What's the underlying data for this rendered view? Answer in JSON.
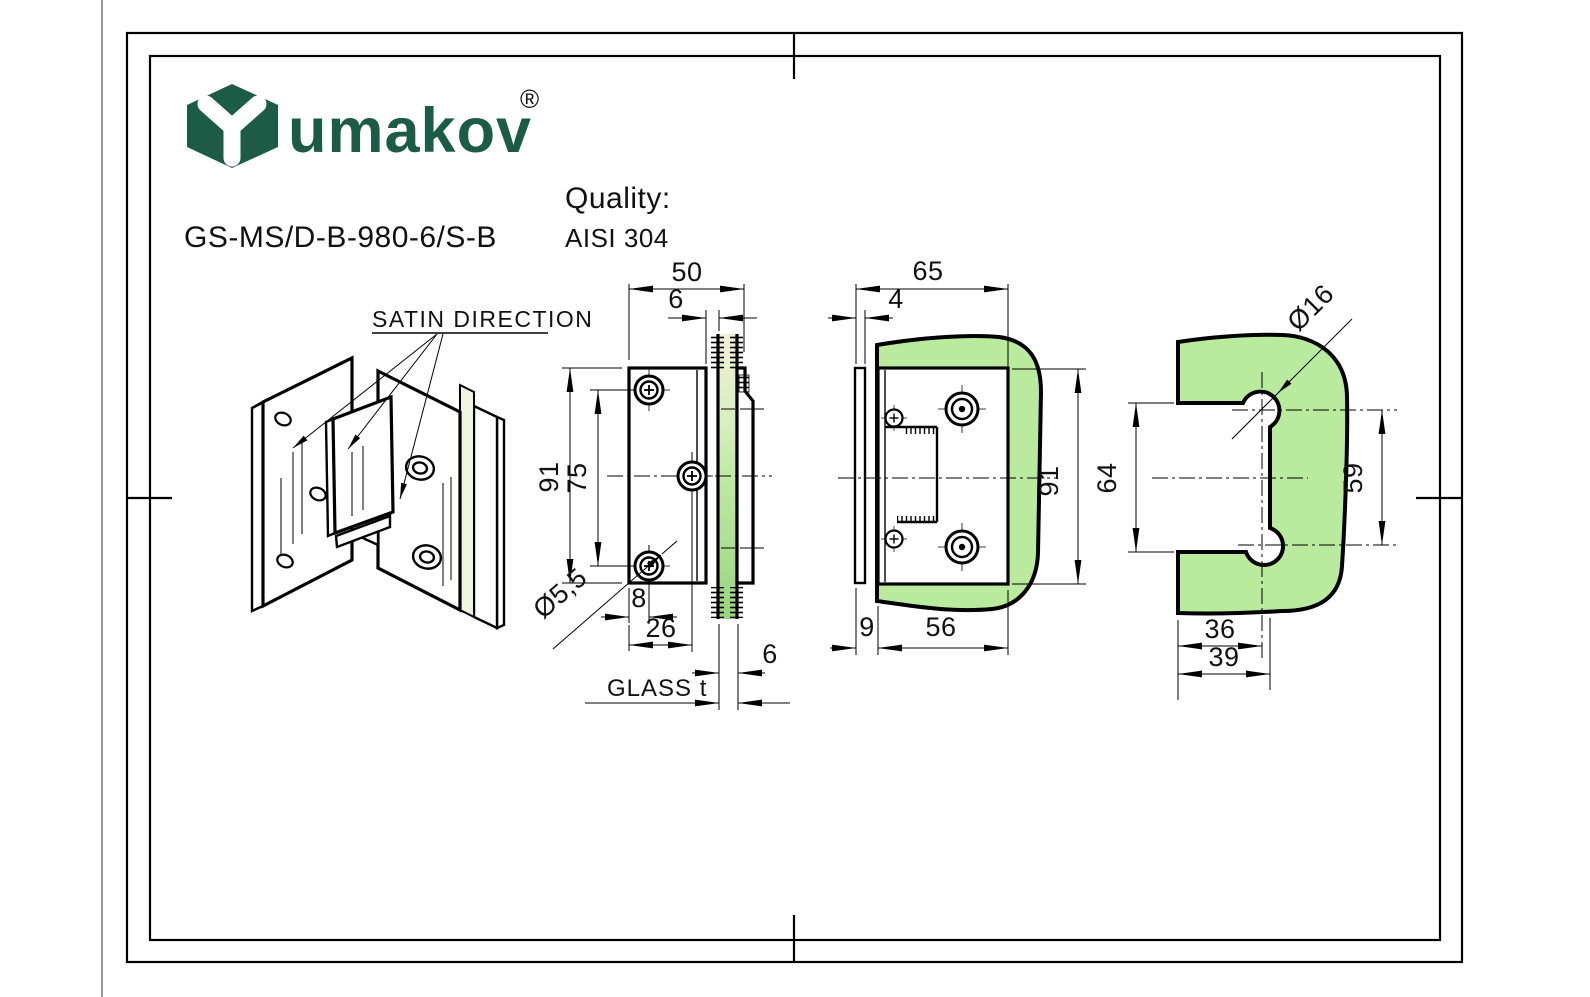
{
  "header": {
    "brand": "umakov",
    "registered": "®",
    "product_code": "GS-MS/D-B-980-6/S-B",
    "quality_label": "Quality:",
    "quality_value": "AISI 304"
  },
  "colors": {
    "brand_green": "#1c5b46",
    "glass_green": "#b9ea9e",
    "line_black": "#000000"
  },
  "isometric_view": {
    "satin_label": "SATIN DIRECTION"
  },
  "front_view": {
    "dim_width": "50",
    "dim_offset": "6",
    "dim_height": "91",
    "dim_hole_spacing": "75",
    "dim_hole_dia": "Ø5,5",
    "dim_edge_hole": "8",
    "dim_edge_center": "26",
    "dim_glass_thk": "6",
    "glass_label": "GLASS t"
  },
  "side_view": {
    "dim_width": "65",
    "dim_plate_thk": "4",
    "dim_height": "91",
    "dim_offset": "9",
    "dim_body": "56"
  },
  "glass_view": {
    "dim_hole_dia": "Ø16",
    "dim_cutout_h": "64",
    "dim_hole_spacing": "59",
    "dim_center": "36",
    "dim_cutout_w": "39"
  }
}
